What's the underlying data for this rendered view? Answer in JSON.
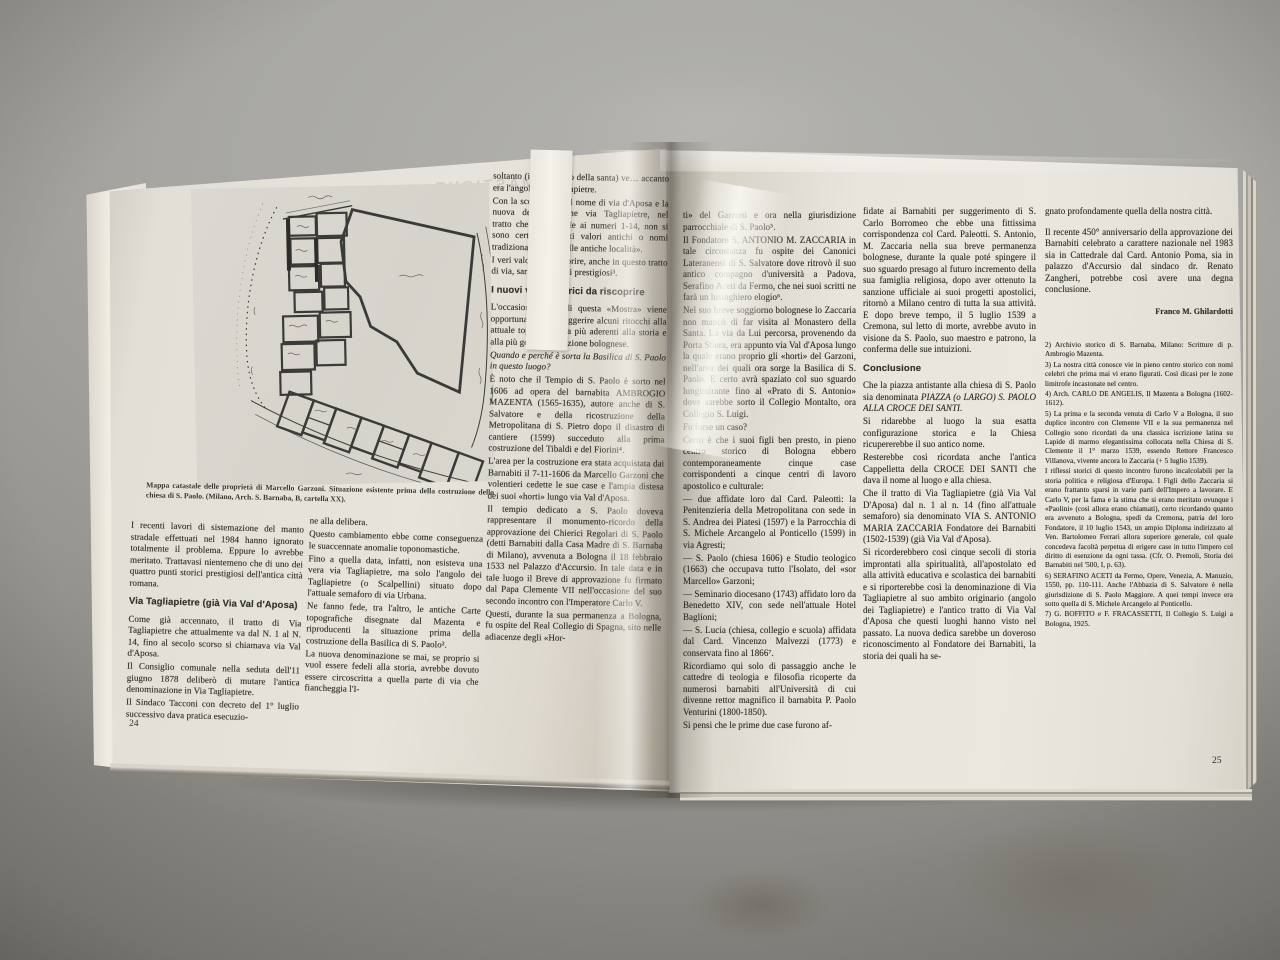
{
  "colors": {
    "surface_gray": "#a7a6a2",
    "page_cream": "#e8e5dc",
    "ink": "#34322d"
  },
  "left_page": {
    "page_number": "24",
    "show_through_text": "MASTICHE",
    "map": {
      "caption": "Mappa catastale delle proprietà di Marcello Garzoni. Situazione esistente prima della costruzione della chiesa di S. Paolo. (Milano, Arch. S. Barnaba, B, cartella XX)."
    },
    "col1": {
      "p1": "I recenti lavori di sistemazione del manto stradale effettuati nel 1984 hanno ignorato totalmente il problema. Eppure lo avrebbe meritato. Trattavasi nientemeno che di uno dei quattro punti storici prestigiosi dell'antica città romana.",
      "heading": "Via Tagliapietre (già Via Val d'Aposa)",
      "p2": "Come già accennato, il tratto di Via Tagliapietre che attualmente va dal N. 1 al N. 14, fino al secolo scorso si chiamava via Val d'Aposa.",
      "p3": "Il Consiglio comunale nella seduta dell'11 giugno 1878 deliberò di mutare l'antica denominazione in Via Tagliapietre.",
      "p4": "Il Sindaco Tacconi con decreto del 1° luglio successivo dava pratica esecuzio-"
    },
    "col2": {
      "p1": "ne alla delibera.",
      "p2": "Questo cambiamento ebbe come conseguenza le suaccennate anomalie toponomastiche.",
      "p3": "Fino a quella data, infatti, non esisteva una vera via Tagliapietre, ma solo l'angolo dei Tagliapietre (o Scalpellini) situato dopo l'attuale semaforo di via Urbana.",
      "p4": "Ne fanno fede, tra l'altro, le antiche Carte topografiche disegnate dal Mazenta e riproducenti la situazione prima della costruzione della Basilica di S. Paolo².",
      "p5": "La nuova denominazione se mai, se proprio si vuol essere fedeli alla storia, avrebbe dovuto essere circoscritta a quella parte di via che fiancheggia l'I-"
    },
    "col3": {
      "p1": "soltanto (il Monastero della santa) ve… accanto era l'angolo dei Tagliapietre.",
      "p2": "Con la scomparsa del nome di via d'Aposa e la nuova denominazione via Tagliapietre, nel tratto che corrisponde ai numeri 1-14, non si sono certo ricuperati valori antichi o nomi tradizionali propri delle antiche località».",
      "p3": "I veri valori da riscoprire, anche in questo tratto di via, sarebbero assai prestigiosi³.",
      "heading": "I nuovi valori storici da riscoprire",
      "p4": "L'occasione felice di questa «Mostra» viene opportunamente a suggerire alcuni ritocchi alla attuale toponomastica più aderenti alla storia e alla più genuina tradizione bolognese.",
      "q": "Quando e perché è sorta la Basilica di S. Paolo in questo luogo?",
      "p6": "È noto che il Tempio di S. Paolo è sorto nel 1606 ad opera del barnabita AMBROGIO MAZENTA (1565-1635), autore anche di S. Salvatore e della ricostruzione della Metropolitana di S. Pietro dopo il disastro di cantiere (1599) succeduto alla prima costruzione del Tibaldi e del Fiorini⁴.",
      "p7": "L'area per la costruzione era stata acquistata dai Barnabiti il 7-11-1606 da Marcello Garzoni che volentieri cedette le sue case e l'ampia distesa dei suoi «horti» lungo via Val d'Aposa.",
      "p8": "Il tempio dedicato a S. Paolo doveva rappresentare il monumento-ricordo della approvazione dei Chierici Regolari di S. Paolo (detti Barnabiti dalla Casa Madre di S. Barnaba di Milano), avvenuta a Bologna il 18 febbraio 1533 nel Palazzo d'Accursio. In tale data e in tale luogo il Breve di approvazione fu firmato dal Papa Clemente VII nell'occasione del suo secondo incontro con l'Imperatore Carlo V.",
      "p9": "Questi, durante la sua permanenza a Bologna, fu ospite del Real Collegio di Spagna, sito nelle adiacenze degli «Hor-"
    }
  },
  "right_page": {
    "page_number": "25",
    "col1": {
      "p1": "ti» del Garzoni e ora nella giurisdizione parrocchiale di S. Paolo⁵.",
      "p2": "Il Fondatore S. ANTONIO M. ZACCARIA in tale circostanza fu ospite dei Canonici Lateranensi di S. Salvatore dove ritrovò il suo antico compagno d'università a Padova, Serafino Aceti da Fermo, che nei suoi scritti ne farà un lusinghiero elogio⁶.",
      "p3": "Nel suo breve soggiorno bolognese lo Zaccaria non mancò di far visita al Monastero della Santa. La via da Lui percorsa, provenendo da Porta Stiera, era appunto via Val d'Aposa lungo la quale erano proprio gli «horti» del Garzoni, nell'area dei quali ora sorge la Basilica di S. Paolo. E certo avrà spaziato col suo sguardo lungimirante fino al «Prato di S. Antonio» dove sarebbe sorto il Collegio Montalto, ora Collegio S. Luigi.",
      "p4": "Fu forse un caso?",
      "p5": "Certo è che i suoi figli ben presto, in pieno centro storico di Bologna ebbero contemporaneamente cinque case corrispondenti a cinque centri di lavoro apostolico e culturale:",
      "list": [
        "— due affidate loro dal Card. Paleotti: la Penitenzieria della Metropolitana con sede in S. Andrea dei Piatesi (1597) e la Parrocchia di S. Michele Arcangelo al Ponticello (1599) in via Agresti;",
        "— S. Paolo (chiesa 1606) e Studio teologico (1663) che occupava tutto l'Isolato, del «sor Marcello» Garzoni;",
        "— Seminario diocesano (1743) affidato loro da Benedetto XIV, con sede nell'attuale Hotel Baglioni;",
        "— S. Lucia (chiesa, collegio e scuola) affidata dal Card. Vincenzo Malvezzi (1773) e conservata fino al 1866⁷."
      ],
      "p7": "Ricordiamo qui solo di passaggio anche le cattedre di teologia e filosofia ricoperte da numerosi barnabiti all'Università di cui divenne rettor magnifico il barnabita P. Paolo Venturini (1800-1850).",
      "p8": "Si pensi che le prime due case furono af-"
    },
    "col2": {
      "p1": "fidate ai Barnabiti per suggerimento di S. Carlo Borromeo che ebbe una fittissima corrispondenza col Card. Paleotti. S. Antonio, M. Zaccaria nella sua breve permanenza bolognese, durante la quale poté spingere il suo sguardo presago al futuro incremento della sua famiglia religiosa, dopo aver ottenuto la sanzione ufficiale ai suoi progetti apostolici, ritornò a Milano centro di tutta la sua attività. E dopo breve tempo, il 5 luglio 1539 a Cremona, sul letto di morte, avrebbe avuto in visione da S. Paolo, suo maestro e patrono, la conferma delle sue intuizioni.",
      "heading": "Conclusione",
      "p2": "A conclusione di questo breve «excursus» proponiamo:",
      "p3a": "Che la piazza antistante alla chiesa di S. Paolo sia denominata ",
      "p3b": "PIAZZA (o LARGO) S. PAOLO ALLA CROCE DEI SANTI.",
      "p4": "Si ridarebbe al luogo la sua esatta configurazione storica e la Chiesa ricupererebbe il suo antico nome.",
      "p5": "Resterebbe così ricordata anche l'antica Cappelletta della CROCE DEI SANTI che dava il nome al luogo e alla chiesa.",
      "p6": "Che il tratto di Via Tagliapietre (già Via Val D'Aposa) dal n. 1 al n. 14 (fino all'attuale semaforo) sia denominato VIA S. ANTONIO MARIA ZACCARIA Fondatore dei Barnabiti (1502-1539) (già Via Val d'Aposa).",
      "p7": "Si ricorderebbero così cinque secoli di storia improntati alla spiritualità, all'apostolato ed alla attività educativa e scolastica dei barnabiti e si riporterebbe così la denominazione di Via Tagliapietre al suo ambito originario (angolo dei Tagliapietre) e l'antico tratto di Via Val d'Aposa che questi luoghi hanno visto nel passato. La nuova dedica sarebbe un doveroso riconoscimento al Fondatore dei Barnabiti, la storia dei quali ha se-"
    },
    "col3": {
      "p1": "gnato profondamente quella della nostra città.",
      "p2": "Il recente 450° anniversario della approvazione dei Barnabiti celebrato a carattere nazionale nel 1983 sia in Cattedrale dal Card. Antonio Poma, sia in palazzo d'Accursio dal sindaco dr. Renato Zangheri, potrebbe così avere una degna conclusione.",
      "signature": "Franco M. Ghilardotti",
      "footnotes": [
        "2) Archivio storico di S. Barnaba, Milano: Scritture di p. Ambrogio Mazenta.",
        "3) La nostra città conosce vie in pieno centro storico con nomi celebri che prima mai vi erano figurati. Così dicasi per le zone limitrofe incastonate nel centro.",
        "4) Arch. CARLO DE ANGELIS, Il Mazenta a Bologna (1602-1612).",
        "5) La prima e la seconda venuta di Carlo V a Bologna, il suo duplice incontro con Clemente VII e la sua permanenza nel Collegio sono ricordati da una classica iscrizione latina su Lapide di marmo elegantissima collocata nella Chiesa di S. Clemente il 1° marzo 1539, essendo Rettore Francesco Villanova, vivente ancora lo Zaccaria (+ 5 luglio 1539).",
        "I riflessi storici di questo incontro furono incalcolabili per la storia politica e religiosa d'Europa. I Figli dello Zaccaria si erano frattanto sparsi in varie parti dell'Impero a lavorare. E Carlo V, per la fama e la stima che si erano meritato ovunque i «Paolini» (così allora erano chiamati), certo ricordando quanto era avvenuto a Bologna, spedì da Cremona, patria del loro Fondatore, il 10 luglio 1543, un ampio Diploma indirizzato al Ven. Bartolomeo Ferrari allora superiore generale, col quale concedeva facoltà perpetua di erigere case in tutto l'impero col diritto di esenzione da ogni tassa. (Cfr. O. Premoli, Storia dei Barnabiti nel '500, I, p. 63).",
        "6) SERAFINO ACETI da Fermo, Opere, Venezia, A. Manuzio, 1550, pp. 110-111. Anche l'Abbazia di S. Salvatore è nella giurisdizione di S. Paolo Maggiore. A quei tempi invece era sotto quella di S. Michele Arcangelo al Ponticello.",
        "7) G. BOFFITO e F. FRACASSETTI, Il Collegio S. Luigi a Bologna, 1925."
      ]
    }
  }
}
